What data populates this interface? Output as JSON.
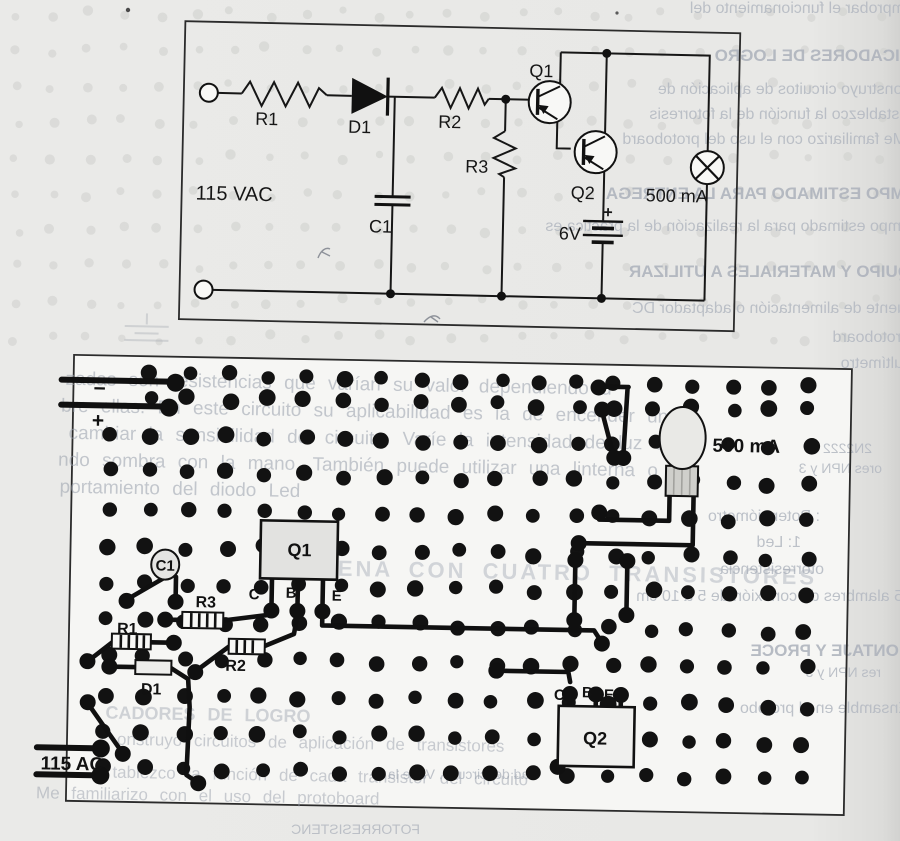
{
  "colors": {
    "paper": "#e8e8e6",
    "board_paper": "#f6f6f4",
    "ink": "#161616",
    "faint_overlay_text": "#99a0ac",
    "bleedthrough_text": "#b3b8c1"
  },
  "schematic": {
    "labels": {
      "input_voltage": "115 VAC",
      "r1": "R1",
      "d1": "D1",
      "r2": "R2",
      "r3": "R3",
      "q1": "Q1",
      "q2": "Q2",
      "c1": "C1",
      "battery_voltage": "6V",
      "battery_polarity": "+",
      "lamp_rating": "500 mA"
    }
  },
  "board": {
    "labels": {
      "c1": "C1",
      "r1": "R1",
      "r2": "R2",
      "r3": "R3",
      "d1": "D1",
      "q1": "Q1",
      "q2": "Q2",
      "lamp_rating": "500 mA",
      "ac_input": "115 AC",
      "minus": "−",
      "plus": "+",
      "q1_pins": {
        "c": "C",
        "b": "B",
        "e": "E"
      },
      "q2_pins": {
        "c": "C",
        "b": "B",
        "e": "E"
      }
    },
    "faint_overlay": {
      "heading": "SIRENA CON CUATRO TRANSISTORES",
      "paragraph_lines": [
        "zadas son resistencias que varían su valor dependiendo d",
        "bre ellas. En este circuito su aplicabilidad es la de encender una",
        "cambiar la sensibilidad del circuito. Varíe la intensidad de luz en la",
        "ndo sombra con la mano. También puede utilizar una linterna o fu",
        "portamiento del diodo Led"
      ],
      "footer_lines": [
        "CADORES DE LOGRO",
        "onstruyo circuitos de aplicación de transistores",
        "tablezco la función de cada transistor del circuito",
        "Me familiarizo con el uso del protoboard"
      ]
    }
  },
  "bleed": {
    "lines": [
      {
        "text": "mprobar el funcionamiento del"
      },
      {
        "text": "DICADORES DE LOGRO"
      },
      {
        "text": "Construyo circuitos de aplicación de"
      },
      {
        "text": "Establezco la función de la fotorresis"
      },
      {
        "text": "Me familiarizo con el uso del protoboard"
      },
      {
        "text": "EMPO ESTIMADO PARA LA ENTREGA"
      },
      {
        "text": "tiempo estimado para la realización de la práctica es"
      },
      {
        "text": "QUIPO Y MATERIALES A UTILIZAR"
      },
      {
        "text": "uente de alimentación o adaptador DC"
      },
      {
        "text": "rotoboard"
      },
      {
        "text": "ultímetro"
      },
      {
        "text": "2N2222"
      },
      {
        "text": "ores NPN y 3"
      },
      {
        "text": ": Potenciómetro"
      },
      {
        "text": "1: Led"
      },
      {
        "text": "otorresistencia"
      },
      {
        "text": "5 alambres de conexión de 5 a 10 cm"
      },
      {
        "text": "MONTAJE Y PROCE"
      },
      {
        "text": "res NPN y 3"
      },
      {
        "text": "Ensamble en el protobo"
      },
      {
        "text": "FOTORRESISTENC"
      },
      {
        "text": "dad del circuito. Varíe la"
      }
    ]
  }
}
